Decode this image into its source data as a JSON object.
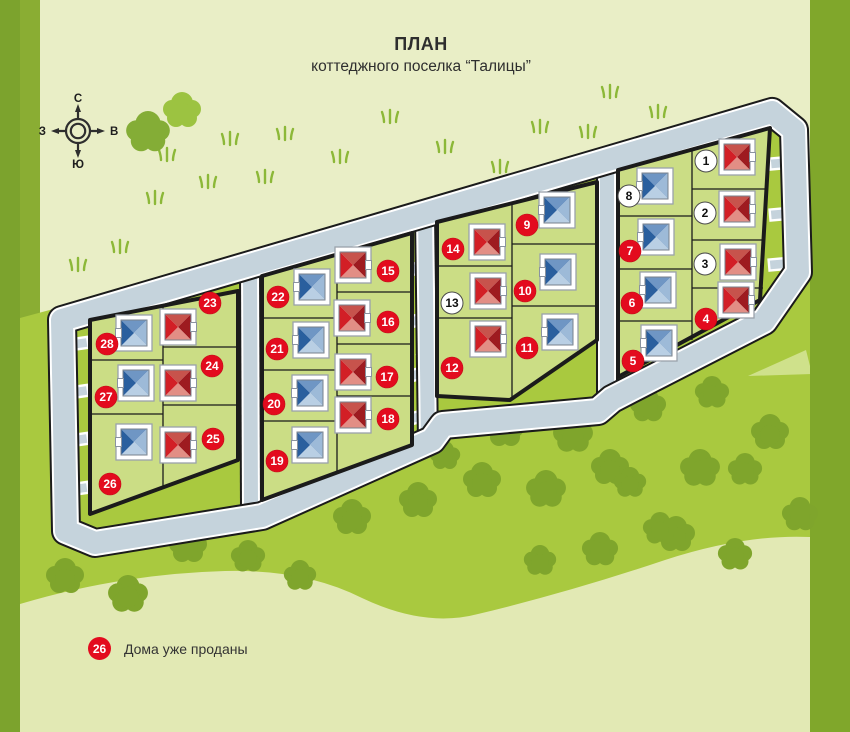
{
  "title": {
    "line1": "ПЛАН",
    "line2": "коттеджного поселка “Талицы”"
  },
  "legend": {
    "badge": "26",
    "text": "Дома уже проданы"
  },
  "compass": {
    "north": "С",
    "east": "В",
    "south": "Ю",
    "west": "З"
  },
  "palette": {
    "pale": "#e9eec6",
    "pale_bottom": "#e2e9b4",
    "field": "#a9c93f",
    "tree": "#7fa52c",
    "grass": "#8cb838",
    "road": "#c5d3dc",
    "curb": "#ffffff",
    "block_fill": "#cbdd85",
    "outline": "#1b1b1b",
    "strip_left1": "#7ca32d",
    "strip_left2": "#8aad33",
    "strip_right": "#80a72b",
    "badge_sold": "#e30b1e",
    "badge_free": "#ffffff",
    "roof_red": {
      "n": "#c7534c",
      "e": "#9e1b20",
      "s": "#e28e85",
      "w": "#d21f26"
    },
    "roof_blue": {
      "n": "#6f96c4",
      "e": "#9dbad8",
      "s": "#b9cfe4",
      "w": "#2a5f9e"
    }
  },
  "map": {
    "lots": [
      {
        "num": 1,
        "roof": "red",
        "sold": false,
        "house": [
          737,
          157
        ],
        "badge": [
          706,
          161
        ]
      },
      {
        "num": 2,
        "roof": "red",
        "sold": false,
        "house": [
          737,
          209
        ],
        "badge": [
          705,
          213
        ]
      },
      {
        "num": 3,
        "roof": "red",
        "sold": false,
        "house": [
          738,
          262
        ],
        "badge": [
          705,
          264
        ]
      },
      {
        "num": 4,
        "roof": "red",
        "sold": true,
        "house": [
          736,
          300
        ],
        "badge": [
          706,
          319
        ]
      },
      {
        "num": 5,
        "roof": "blue",
        "sold": true,
        "house": [
          659,
          343
        ],
        "badge": [
          633,
          361
        ]
      },
      {
        "num": 6,
        "roof": "blue",
        "sold": true,
        "house": [
          658,
          290
        ],
        "badge": [
          632,
          303
        ]
      },
      {
        "num": 7,
        "roof": "blue",
        "sold": true,
        "house": [
          656,
          237
        ],
        "badge": [
          630,
          251
        ]
      },
      {
        "num": 8,
        "roof": "blue",
        "sold": false,
        "house": [
          655,
          186
        ],
        "badge": [
          629,
          196
        ]
      },
      {
        "num": 9,
        "roof": "blue",
        "sold": true,
        "house": [
          557,
          210
        ],
        "badge": [
          527,
          225
        ]
      },
      {
        "num": 10,
        "roof": "blue",
        "sold": true,
        "house": [
          558,
          272
        ],
        "badge": [
          525,
          291
        ]
      },
      {
        "num": 11,
        "roof": "blue",
        "sold": true,
        "house": [
          560,
          332
        ],
        "badge": [
          527,
          348
        ]
      },
      {
        "num": 12,
        "roof": "red",
        "sold": true,
        "house": [
          488,
          339
        ],
        "badge": [
          452,
          368
        ]
      },
      {
        "num": 13,
        "roof": "red",
        "sold": false,
        "house": [
          488,
          291
        ],
        "badge": [
          452,
          303
        ]
      },
      {
        "num": 14,
        "roof": "red",
        "sold": true,
        "house": [
          487,
          242
        ],
        "badge": [
          453,
          249
        ]
      },
      {
        "num": 15,
        "roof": "red",
        "sold": true,
        "house": [
          353,
          265
        ],
        "badge": [
          388,
          271
        ]
      },
      {
        "num": 16,
        "roof": "red",
        "sold": true,
        "house": [
          352,
          318
        ],
        "badge": [
          388,
          322
        ]
      },
      {
        "num": 17,
        "roof": "red",
        "sold": true,
        "house": [
          353,
          372
        ],
        "badge": [
          387,
          377
        ]
      },
      {
        "num": 18,
        "roof": "red",
        "sold": true,
        "house": [
          353,
          415
        ],
        "badge": [
          388,
          419
        ]
      },
      {
        "num": 19,
        "roof": "blue",
        "sold": true,
        "house": [
          310,
          445
        ],
        "badge": [
          277,
          461
        ]
      },
      {
        "num": 20,
        "roof": "blue",
        "sold": true,
        "house": [
          310,
          393
        ],
        "badge": [
          274,
          404
        ]
      },
      {
        "num": 21,
        "roof": "blue",
        "sold": true,
        "house": [
          311,
          340
        ],
        "badge": [
          277,
          349
        ]
      },
      {
        "num": 22,
        "roof": "blue",
        "sold": true,
        "house": [
          312,
          287
        ],
        "badge": [
          278,
          297
        ]
      },
      {
        "num": 23,
        "roof": "red",
        "sold": true,
        "house": [
          178,
          327
        ],
        "badge": [
          210,
          303
        ]
      },
      {
        "num": 24,
        "roof": "red",
        "sold": true,
        "house": [
          178,
          383
        ],
        "badge": [
          212,
          366
        ]
      },
      {
        "num": 25,
        "roof": "red",
        "sold": true,
        "house": [
          178,
          445
        ],
        "badge": [
          213,
          439
        ]
      },
      {
        "num": 26,
        "roof": "blue",
        "sold": true,
        "house": [
          134,
          442
        ],
        "badge": [
          110,
          484
        ]
      },
      {
        "num": 27,
        "roof": "blue",
        "sold": true,
        "house": [
          136,
          383
        ],
        "badge": [
          106,
          397
        ]
      },
      {
        "num": 28,
        "roof": "blue",
        "sold": true,
        "house": [
          134,
          333
        ],
        "badge": [
          107,
          344
        ]
      }
    ],
    "trees": [
      [
        505,
        431,
        1
      ],
      [
        573,
        436,
        1.05
      ],
      [
        648,
        407,
        0.95
      ],
      [
        712,
        394,
        0.9
      ],
      [
        770,
        434,
        1
      ],
      [
        700,
        470,
        1.05
      ],
      [
        352,
        519,
        1
      ],
      [
        418,
        502,
        1
      ],
      [
        482,
        482,
        1
      ],
      [
        546,
        491,
        1.05
      ],
      [
        610,
        469,
        1
      ],
      [
        676,
        536,
        1
      ],
      [
        745,
        471,
        0.9
      ],
      [
        800,
        516,
        0.95
      ],
      [
        188,
        547,
        1
      ],
      [
        248,
        558,
        0.9
      ],
      [
        300,
        577,
        0.85
      ],
      [
        65,
        578,
        1
      ],
      [
        128,
        596,
        1.05
      ],
      [
        540,
        562,
        0.85
      ],
      [
        600,
        551,
        0.95
      ],
      [
        660,
        530,
        0.9
      ],
      [
        445,
        457,
        0.8
      ],
      [
        630,
        484,
        0.85
      ],
      [
        735,
        556,
        0.9
      ]
    ],
    "top_trees": [
      [
        182,
        112,
        1.0,
        "#9cc341"
      ],
      [
        148,
        134,
        1.15,
        "#84ad36"
      ]
    ],
    "grass": [
      [
        167,
        158
      ],
      [
        230,
        142
      ],
      [
        285,
        137
      ],
      [
        208,
        185
      ],
      [
        265,
        180
      ],
      [
        155,
        201
      ],
      [
        610,
        95
      ],
      [
        658,
        115
      ],
      [
        588,
        135
      ],
      [
        340,
        160
      ],
      [
        390,
        120
      ],
      [
        445,
        150
      ],
      [
        500,
        170
      ],
      [
        540,
        130
      ],
      [
        120,
        250
      ],
      [
        78,
        268
      ],
      [
        265,
        277
      ],
      [
        434,
        266
      ],
      [
        540,
        205
      ]
    ],
    "driveways": [
      [
        76,
        344,
        -8
      ],
      [
        76,
        392,
        -8
      ],
      [
        76,
        440,
        -8
      ],
      [
        76,
        489,
        -8
      ],
      [
        244,
        318,
        -15
      ],
      [
        244,
        375,
        -15
      ],
      [
        244,
        430,
        -15
      ],
      [
        256,
        298,
        -15
      ],
      [
        256,
        350,
        -15
      ],
      [
        256,
        403,
        -15
      ],
      [
        256,
        457,
        -15
      ],
      [
        418,
        268,
        -15
      ],
      [
        418,
        320,
        -15
      ],
      [
        418,
        374,
        -15
      ],
      [
        418,
        417,
        -15
      ],
      [
        430,
        247,
        -15
      ],
      [
        430,
        301,
        -15
      ],
      [
        430,
        357,
        -15
      ],
      [
        601,
        220,
        -15
      ],
      [
        601,
        278,
        -15
      ],
      [
        601,
        333,
        -15
      ],
      [
        612,
        188,
        -15
      ],
      [
        612,
        243,
        -15
      ],
      [
        612,
        296,
        -15
      ],
      [
        612,
        348,
        -15
      ],
      [
        782,
        163,
        -5
      ],
      [
        782,
        214,
        -5
      ],
      [
        781,
        264,
        -5
      ],
      [
        779,
        298,
        -25
      ]
    ]
  }
}
